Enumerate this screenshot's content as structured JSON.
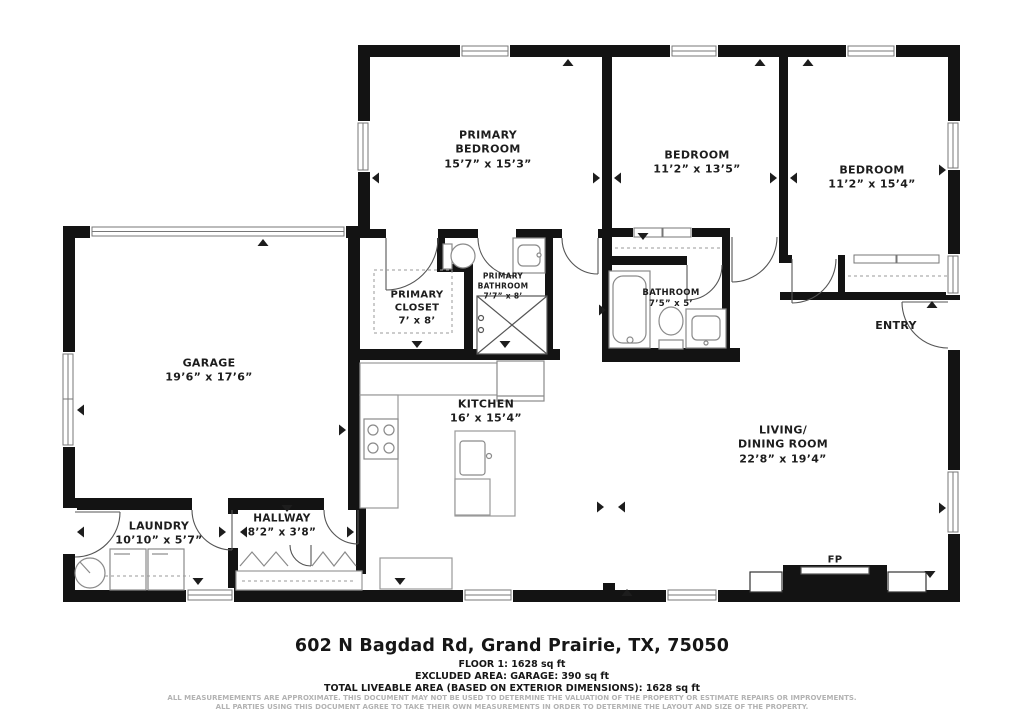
{
  "floor_plan": {
    "rooms": {
      "primary_bedroom": {
        "name": "PRIMARY\nBEDROOM",
        "dims": "15’7” x 15’3”"
      },
      "bedroom_1": {
        "name": "BEDROOM",
        "dims": "11’2” x 13’5”"
      },
      "bedroom_2": {
        "name": "BEDROOM",
        "dims": "11’2” x 15’4”"
      },
      "primary_closet": {
        "name": "PRIMARY\nCLOSET",
        "dims": "7’ x 8’"
      },
      "primary_bathroom": {
        "name": "PRIMARY\nBATHROOM",
        "dims": "7’7” x 8’"
      },
      "bathroom": {
        "name": "BATHROOM",
        "dims": "7’5” x 5’"
      },
      "entry": {
        "name": "ENTRY",
        "dims": ""
      },
      "garage": {
        "name": "GARAGE",
        "dims": "19’6” x 17’6”"
      },
      "kitchen": {
        "name": "KITCHEN",
        "dims": "16’ x 15’4”"
      },
      "living_dining": {
        "name": "LIVING/\nDINING ROOM",
        "dims": "22’8” x 19’4”"
      },
      "laundry": {
        "name": "LAUNDRY",
        "dims": "10’10” x 5’7”"
      },
      "hallway": {
        "name": "HALLWAY",
        "dims": "8’2” x 3’8”"
      },
      "fireplace": {
        "name": "FP",
        "dims": ""
      }
    }
  },
  "footer": {
    "address": "602 N Bagdad Rd, Grand Prairie, TX, 75050",
    "floor_line": "FLOOR 1: 1628 sq ft",
    "excluded_line": "EXCLUDED AREA: GARAGE: 390 sq ft",
    "total_line": "TOTAL LIVEABLE AREA (BASED ON EXTERIOR DIMENSIONS): 1628 sq ft",
    "disclaimer_line1": "ALL MEASUREMEMENTS ARE APPROXIMATE. THIS DOCUMENT MAY NOT BE USED TO DETERMINE THE VALUATION OF THE PROPERTY OR ESTIMATE REPAIRS OR IMPROVEMENTS.",
    "disclaimer_line2": "ALL PARTIES USING THIS DOCUMENT AGREE TO TAKE THEIR OWN MEASUREMENTS IN ORDER TO DETERMINE THE LAYOUT AND SIZE OF THE PROPERTY."
  },
  "colors": {
    "wall": "#131313",
    "fixture_outline": "#8a8a8a",
    "label_text": "#1d1d1d",
    "disclaimer_text": "#b3b3b3"
  }
}
